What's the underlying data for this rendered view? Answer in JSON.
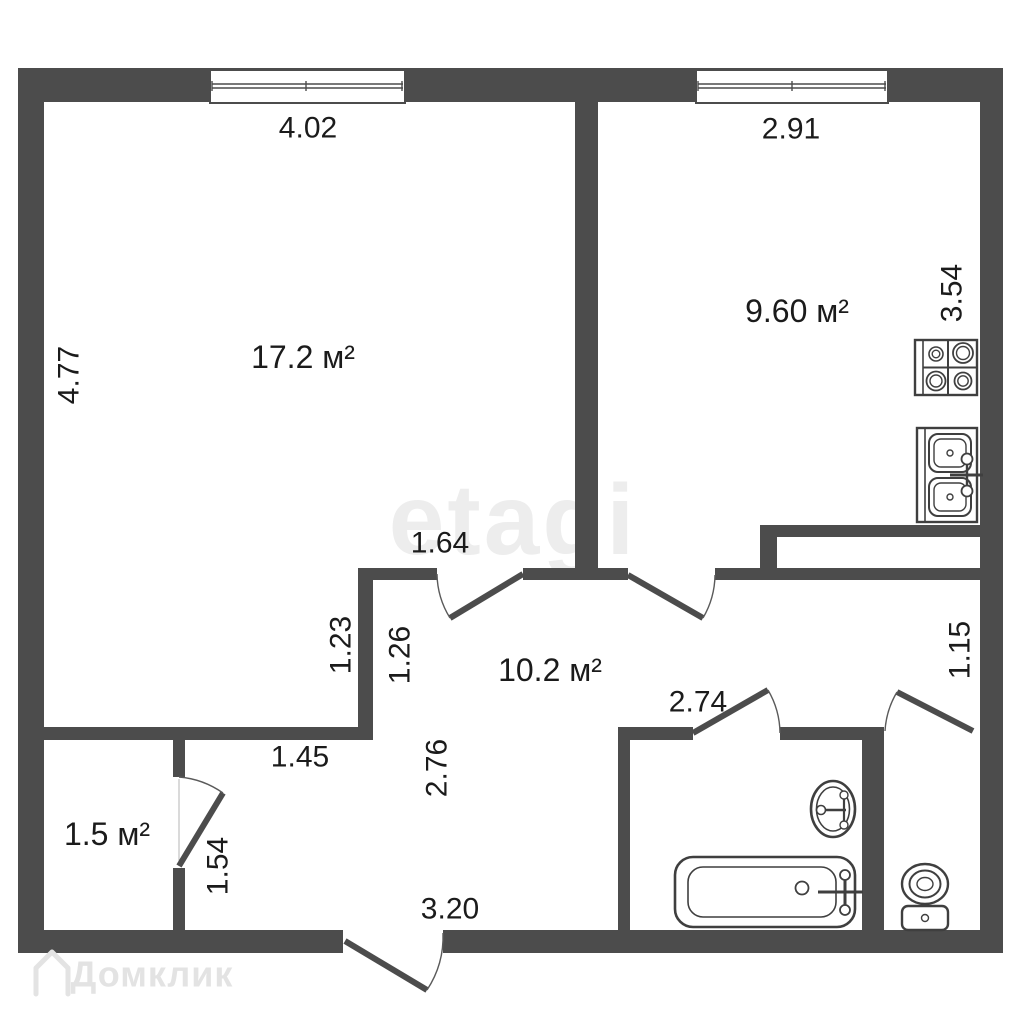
{
  "plan": {
    "title": "apartment-floor-plan",
    "watermarks": {
      "center": "etagi",
      "bottom_left": "Домклик"
    },
    "rooms": {
      "living": {
        "area": "17.2 м²"
      },
      "kitchen": {
        "area": "9.60 м²"
      },
      "hallway": {
        "area": "10.2 м²"
      },
      "storage": {
        "area": "1.5 м²"
      }
    },
    "dimensions": {
      "living_top": "4.02",
      "kitchen_top": "2.91",
      "living_left": "4.77",
      "kitchen_right": "3.54",
      "living_door": "1.64",
      "living_nook": "1.23",
      "hall_top_left": "1.26",
      "corridor_width": "1.45",
      "hall_height": "2.76",
      "hall_bottom": "3.20",
      "bath_top": "2.74",
      "toilet_right": "1.15",
      "storage_door": "1.54"
    },
    "fixtures": [
      "stove",
      "kitchen-sink",
      "bathtub",
      "washbasin",
      "toilet"
    ],
    "colors": {
      "wall": "#4c4c4c",
      "text": "#1b1b1b",
      "fixture_stroke": "#3f3f3f",
      "watermark_center": "#ededed",
      "watermark_bottom": "#e3e3e3",
      "background": "#ffffff"
    }
  }
}
